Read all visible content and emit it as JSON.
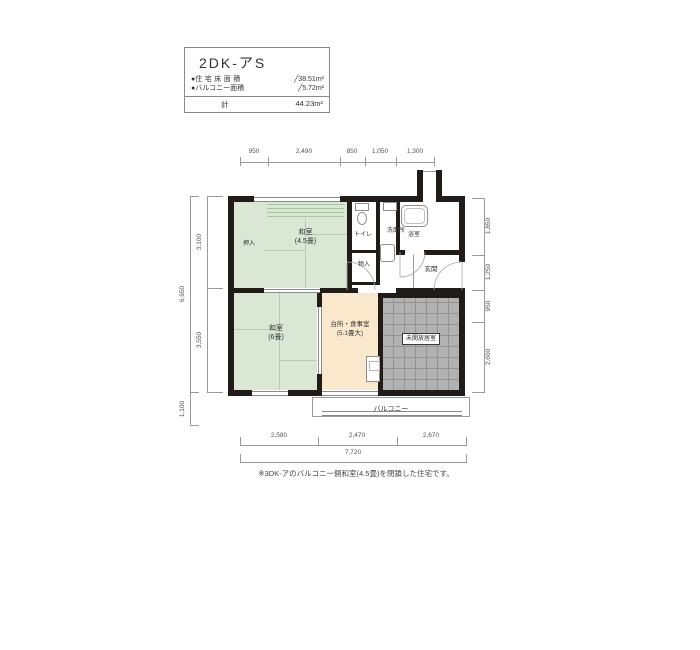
{
  "title_box": {
    "title": "2DK-アS",
    "bullet": "●",
    "items": [
      {
        "label": "住宅床面積",
        "value": "╱38.51m²"
      },
      {
        "label": "バルコニー面積",
        "value": "╱5.72m²"
      }
    ],
    "total_label": "計",
    "total_value": "44.23m²"
  },
  "rooms": {
    "oshiire": "押入",
    "washitsu45_name": "和室",
    "washitsu45_size": "(4.5畳)",
    "toilet": "トイレ",
    "monoire": "物入",
    "senmenjo": "洗面所",
    "yokushitsu": "浴室",
    "genkan": "玄関",
    "washitsu6_name": "和室",
    "washitsu6_size": "(6畳)",
    "dk_name": "台所・食事室",
    "dk_size": "(5.1畳大)",
    "closed_room": "未開放居室",
    "balcony": "バルコニー"
  },
  "dimensions": {
    "top": [
      "950",
      "2,490",
      "850",
      "1,050",
      "1,300"
    ],
    "left_outer": [
      "6,650",
      "1,100"
    ],
    "left_inner": [
      "3,100",
      "3,550"
    ],
    "right": [
      "1,850",
      "1,250",
      "950",
      "2,600"
    ],
    "bottom": [
      "2,580",
      "2,470",
      "2,670"
    ],
    "bottom_total": "7,720"
  },
  "note": "※3DK-アのバルコニー側和室(4.5畳)を閉鎖した住宅です。",
  "colors": {
    "tatami_green": "#d9e7d4",
    "kitchen_peach": "#fae8cc",
    "closed_room_gray": "#b2b2b2",
    "wall_black": "#211c17"
  }
}
